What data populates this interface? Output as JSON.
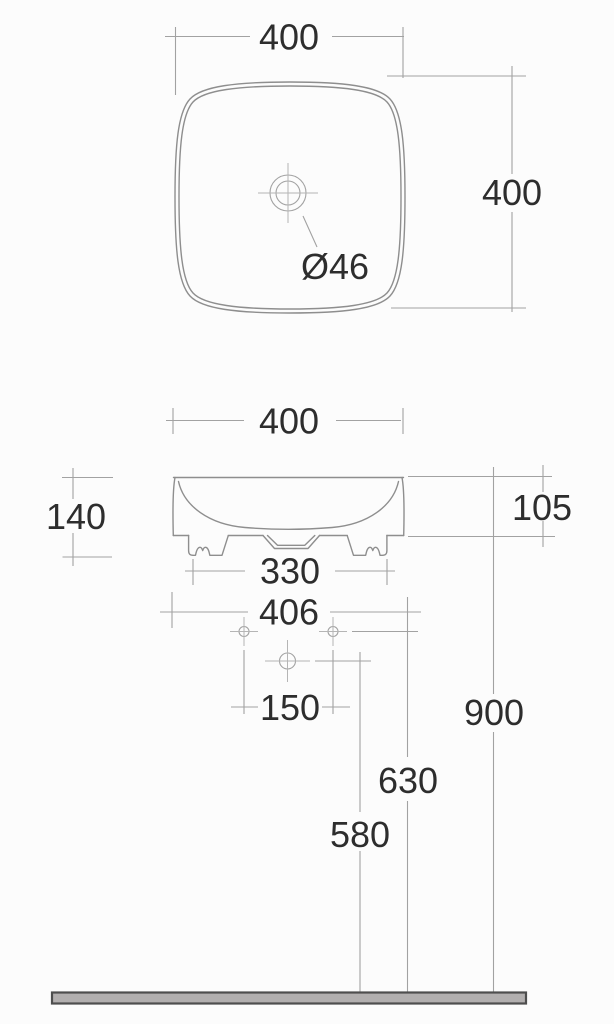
{
  "meta": {
    "type": "technical-dimension-drawing",
    "subject": "countertop washbasin, top view and front elevation with installation heights"
  },
  "colors": {
    "outline": "#8e8e8e",
    "dimension_line": "#a2a2a2",
    "centerline": "#b5b5b5",
    "text": "#2d2d2d",
    "floor_fill": "#b2afaf",
    "floor_stroke": "#4e4e4e",
    "background": "#fcfcfc"
  },
  "top_view": {
    "width_label": "400",
    "height_label": "400",
    "drain_label": "Ø46"
  },
  "front_view": {
    "width_label": "400",
    "total_height_label": "140",
    "body_height_label": "105",
    "feet_span_label": "330",
    "overall_width_label": "406",
    "hole_spacing_label": "150",
    "fixing_holes_height_label": "630",
    "drain_height_label": "580",
    "rim_height_label": "900"
  }
}
